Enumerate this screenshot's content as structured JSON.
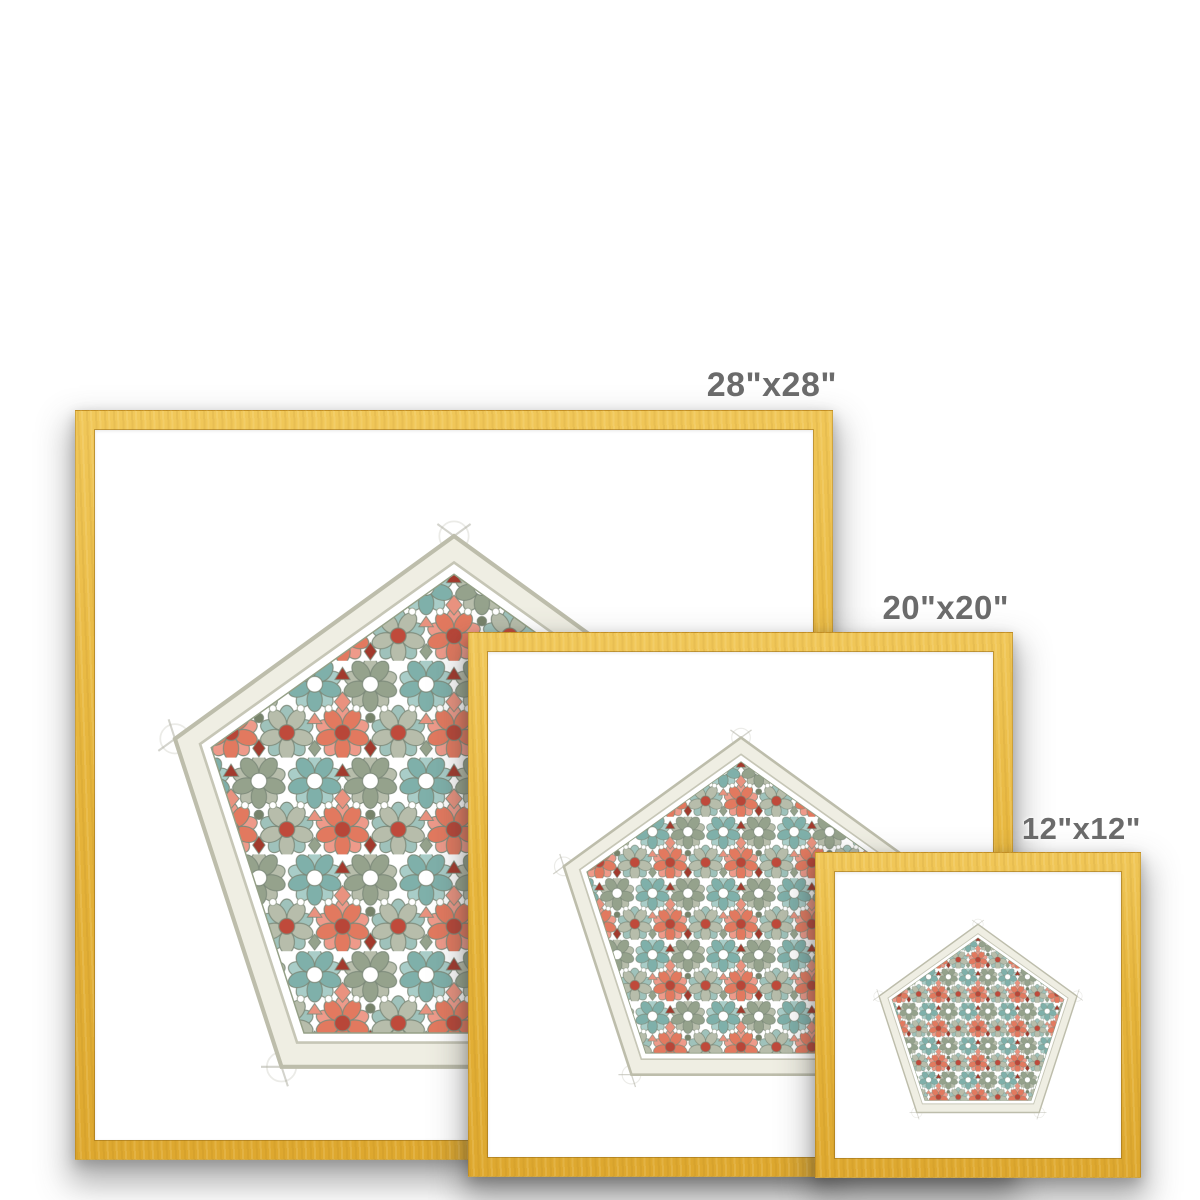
{
  "page": {
    "background_color": "#ffffff"
  },
  "sizes": [
    {
      "id": "28x28",
      "label": "28\"x28\""
    },
    {
      "id": "20x20",
      "label": "20\"x20\""
    },
    {
      "id": "12x12",
      "label": "12\"x12\""
    }
  ],
  "frame": {
    "style": "gold wood frame with white mat",
    "frame_color": "#e6b53c",
    "frame_edge_color": "#b9892a",
    "mat_color": "#ffffff",
    "label_text_color": "#6b6b6b"
  },
  "artwork": {
    "title": "Pentagon geometric pattern print",
    "shape": "pentagon",
    "style": "Islamic five-fold star rosette pattern, watercolor with pencil construction lines",
    "palette": {
      "teal_light": "#a9cdc8",
      "teal": "#7fb0aa",
      "sage_light": "#b7bdab",
      "sage": "#95a28c",
      "olive": "#77836b",
      "coral": "#ee9a8a",
      "coral_deep": "#e2795f",
      "brick_red": "#b84638",
      "dark_red": "#a23a2d",
      "border_band": "#efeee3",
      "band_line": "#bdbdab",
      "outline": "#7d8a7a"
    }
  }
}
